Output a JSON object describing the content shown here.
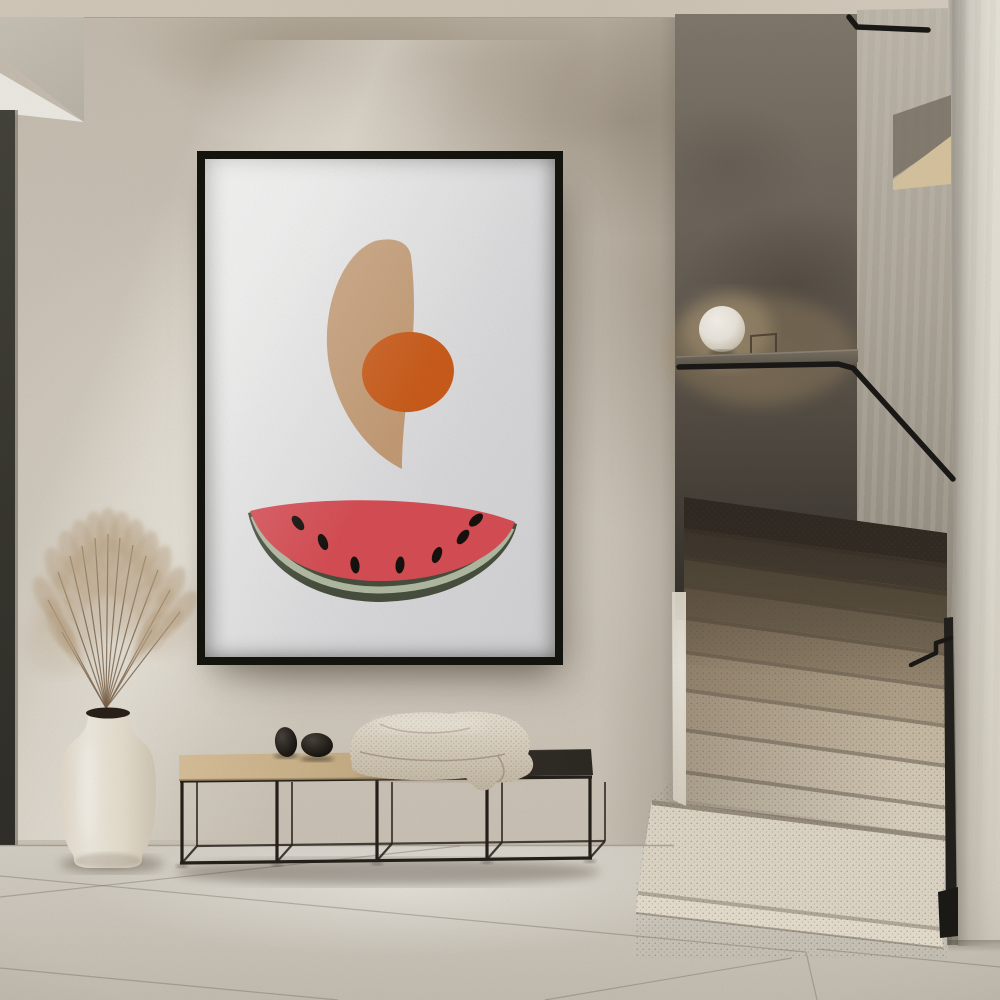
{
  "scene": {
    "type": "interior-photograph",
    "width": 1000,
    "height": 1000
  },
  "palette": {
    "ceiling": "#D5CBBB",
    "wall": "#CFC7BA",
    "door_edge": "#3E3D35",
    "floor": "#D6D1C7",
    "floor_seam": "#7D7567",
    "frame": "#15140F",
    "art_bg_light": "#F2F2F1",
    "art_bg_dark": "#D7D7D9",
    "crescent": "#C89F78",
    "orange": "#CE5E1C",
    "melon_red": "#DB5057",
    "rind_outer": "#49513F",
    "rind_inner": "#B5BEA6",
    "seed": "#18120D",
    "stair_wall_top": "#837B6E",
    "stair_wall_bottom": "#332F29",
    "side_wall": "#B0A99C",
    "right_wall": "#E9E4DA",
    "handrail": "#1B1A17",
    "lamp": "#F5F1E8",
    "ledge": "#6F675C",
    "bench_metal": "#26211B",
    "bench_wood_light": "#DCC49C",
    "bench_wood_dark": "#C6AC82",
    "bench_dark_top": "#37322B",
    "stone": "#221E19",
    "blanket_light": "#EEE7D9",
    "blanket_dark": "#C6BAA6",
    "vase": "#EFE8DB",
    "pampas": "#BEA686",
    "pampas_stem": "#7C6348",
    "step_bright": "#E6DECE",
    "step_dark": "#4E463A"
  },
  "artwork": {
    "frame": {
      "x": 197,
      "y": 151,
      "width": 366,
      "height": 514,
      "border": 8
    },
    "crescent_path": "M 170 82 C 191 77 204 84 206 97 C 210 130 210 162 206 196 C 202 242 197 274 197 310 C 172 298 141 268 127 219 C 112 166 131 97 170 82 Z",
    "orange": {
      "cx": 203,
      "cy": 213,
      "rx": 46,
      "ry": 40,
      "rotate": -6
    },
    "watermelon": {
      "outer": "M 43 354 C 95 339 238 336 312 365 C 303 406 247 443 172 443 C 99 441 54 403 43 354 Z",
      "band": "M 49 357 C 62 396 105 430 172 431 C 240 431 291 403 306 369",
      "flesh": "M 45 352 C 100 337 240 335 310 363 C 298 396 245 423 171 422 C 102 420 60 393 45 352 Z",
      "seeds": [
        [
          93,
          364,
          -38
        ],
        [
          118,
          383,
          -22
        ],
        [
          150,
          406,
          -8
        ],
        [
          195,
          406,
          6
        ],
        [
          232,
          396,
          22
        ],
        [
          258,
          378,
          38
        ],
        [
          271,
          361,
          48
        ]
      ]
    }
  },
  "staircase": {
    "left_x": 684,
    "right_x": 947,
    "right_drop": 36,
    "clip": "684,497 947,533 947,958 636,958 636,886 652,796 684,770",
    "bands": [
      {
        "y": 497,
        "h": 31,
        "c": "#39332B"
      },
      {
        "y": 528,
        "h": 28,
        "c": "#4F463A"
      },
      {
        "y": 556,
        "h": 28,
        "c": "#645946"
      },
      {
        "y": 584,
        "h": 32,
        "c": "#7C6E5A"
      },
      {
        "y": 616,
        "h": 34,
        "c": "#998972"
      },
      {
        "y": 650,
        "h": 38,
        "c": "#B6A68E"
      },
      {
        "y": 688,
        "h": 40,
        "c": "#CDBFA9"
      },
      {
        "y": 728,
        "h": 42,
        "c": "#D9CEBA"
      },
      {
        "y": 770,
        "h": 30,
        "c": "#E0D7C5"
      }
    ],
    "platform_tread": {
      "points": [
        [
          652,
          800
        ],
        [
          947,
          836
        ],
        [
          941,
          927
        ],
        [
          638,
          891
        ]
      ],
      "c": "#E3DBCB"
    },
    "platform_face": {
      "points": [
        [
          638,
          891
        ],
        [
          941,
          927
        ],
        [
          943,
          948
        ],
        [
          636,
          913
        ]
      ],
      "c": "#EBE3D3"
    },
    "corner_strip": [
      [
        672,
        592
      ],
      [
        686,
        592
      ],
      [
        686,
        806
      ],
      [
        673,
        800
      ]
    ]
  },
  "handrail": {
    "main": [
      [
        679,
        367
      ],
      [
        838,
        364
      ],
      [
        853,
        368
      ],
      [
        953,
        479
      ]
    ],
    "upper": [
      [
        849,
        17
      ],
      [
        857,
        27
      ],
      [
        928,
        30
      ]
    ],
    "bracket": [
      [
        911,
        665
      ],
      [
        936,
        653
      ],
      [
        936,
        643
      ],
      [
        951,
        638
      ]
    ],
    "post": [
      [
        944,
        618
      ],
      [
        953,
        617
      ],
      [
        957,
        930
      ],
      [
        946,
        934
      ]
    ],
    "post_base": [
      [
        938,
        892
      ],
      [
        958,
        887
      ],
      [
        958,
        936
      ],
      [
        940,
        938
      ]
    ]
  },
  "ledge": {
    "points": [
      [
        676,
        356
      ],
      [
        858,
        349
      ],
      [
        858,
        362
      ],
      [
        676,
        370
      ]
    ]
  },
  "niche": {
    "dark": [
      [
        893,
        115
      ],
      [
        951,
        95
      ],
      [
        951,
        138
      ],
      [
        893,
        178
      ]
    ],
    "wedge": [
      [
        893,
        180
      ],
      [
        951,
        136
      ],
      [
        951,
        184
      ],
      [
        893,
        190
      ]
    ]
  },
  "lamp": {
    "cx": 722,
    "cy": 329,
    "r": 23,
    "stand": "751,357 751,336 776,334 776,355"
  },
  "floor": {
    "top_y": 845,
    "junction": [
      0,
      845.5,
      674,
      845.5
    ],
    "seams": [
      [
        0,
        876,
        806,
        952
      ],
      [
        806,
        952,
        817,
        1000
      ],
      [
        817,
        949,
        1000,
        967
      ],
      [
        0,
        897,
        460,
        846
      ],
      [
        0,
        968,
        338,
        1000
      ],
      [
        545,
        1000,
        792,
        958
      ]
    ]
  },
  "bench": {
    "front_uprights": [
      182,
      277,
      377,
      487,
      590
    ],
    "back_offset": 15,
    "top_rail": [
      180,
      781,
      592,
      777
    ],
    "bottom_rail": [
      180,
      863,
      592,
      858
    ],
    "back_rail": [
      197,
      846,
      605,
      841
    ],
    "slab_wood": [
      [
        179,
        755
      ],
      [
        403,
        752
      ],
      [
        403,
        778
      ],
      [
        179,
        780
      ]
    ],
    "slab_dark": [
      [
        403,
        752
      ],
      [
        591,
        749
      ],
      [
        593,
        775
      ],
      [
        403,
        778
      ]
    ],
    "stones": [
      {
        "cx": 286,
        "cy": 742,
        "rx": 11,
        "ry": 15,
        "rot": -8
      },
      {
        "cx": 317,
        "cy": 745,
        "rx": 16,
        "ry": 12,
        "rot": 5
      }
    ],
    "shadow": {
      "cx": 388,
      "cy": 872,
      "rx": 212,
      "ry": 13
    }
  },
  "blanket": {
    "outline": "M 352 764 C 346 744 354 728 372 721 C 390 713 428 710 450 714 C 468 709 498 712 512 720 C 528 728 533 742 528 754 C 535 760 535 770 527 775 C 516 781 505 784 497 782 C 492 790 482 793 476 788 C 470 783 468 780 466 778 C 428 782 390 780 368 776 C 356 773 350 770 352 764 Z",
    "folds": [
      "M 380 724 C 400 734 440 736 470 728",
      "M 360 752 C 400 762 460 764 505 754",
      "M 498 756 C 506 768 506 778 497 782"
    ]
  },
  "vase": {
    "path": "M 88 714 C 88 726 84 733 74 741 C 64 749 60 763 60 786 C 60 822 64 843 72 853 C 74 856 74 858 74 860 C 74 865 80 868 92 868 L 124 868 C 136 868 142 865 142 860 C 142 857 142 855 144 852 C 152 841 156 820 156 785 C 156 762 152 749 142 741 C 132 733 128 726 128 714 Z",
    "mouth": {
      "cx": 108,
      "cy": 713,
      "rx": 22,
      "ry": 5.5
    },
    "shadow": {
      "cx": 112,
      "cy": 864,
      "rx": 52,
      "ry": 9
    }
  },
  "pampas": {
    "origin": [
      106,
      708
    ],
    "tips": [
      [
        48,
        600
      ],
      [
        58,
        572
      ],
      [
        70,
        556
      ],
      [
        82,
        546
      ],
      [
        95,
        538
      ],
      [
        108,
        534
      ],
      [
        120,
        538
      ],
      [
        133,
        545
      ],
      [
        146,
        556
      ],
      [
        158,
        570
      ],
      [
        170,
        590
      ],
      [
        180,
        612
      ],
      [
        62,
        632
      ],
      [
        152,
        630
      ]
    ],
    "blobs": [
      [
        80,
        600,
        45
      ],
      [
        125,
        585,
        50
      ],
      [
        60,
        640,
        35
      ],
      [
        160,
        615,
        40
      ],
      [
        112,
        560,
        42
      ]
    ]
  }
}
